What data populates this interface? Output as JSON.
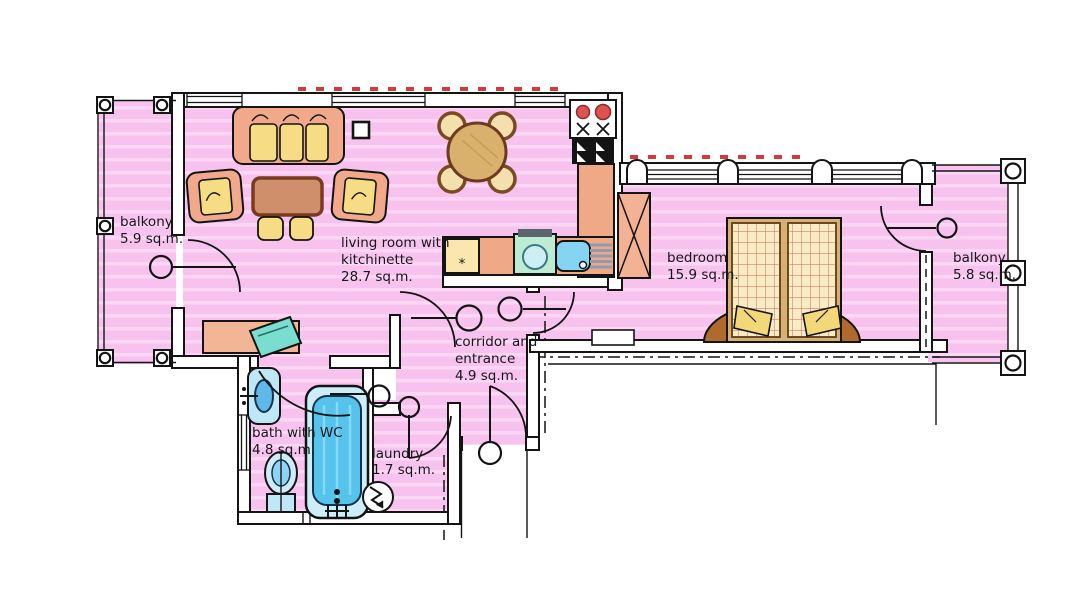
{
  "rooms": {
    "balcony_left": {
      "name": "balkony",
      "area": "5.9 sq.m."
    },
    "living": {
      "line1": "living room with",
      "line2": "kitchinette",
      "area": "28.7 sq.m."
    },
    "bedroom": {
      "name": "bedroom",
      "area": "15.9 sq.m."
    },
    "balcony_right": {
      "name": "balkony",
      "area": "5.8 sq.m."
    },
    "corridor": {
      "line1": "corridor and",
      "line2": "entrance",
      "area": "4.9 sq.m."
    },
    "bath": {
      "name": "bath with WC",
      "area": "4.8 sq.m."
    },
    "laundry": {
      "name": "laundry",
      "area": "1.7 sq.m."
    }
  },
  "kitchen": {
    "fridge_symbol": "*"
  },
  "colors": {
    "room_fill": "#f7c3ee",
    "room_fill_stripe": "#fbd7f5",
    "wall_fill": "#ffffff",
    "line": "#141414",
    "furniture_salmon": "#f2a98b",
    "cushion_yellow": "#f6dd85",
    "table_brown": "#d08f6b",
    "wood_dark": "#7a3a20",
    "bed_blanket": "#f7ecc4",
    "bed_plaid_line": "#d2806a",
    "headboard_brown": "#b06a2e",
    "fixture_light_blue": "#bfe7f5",
    "water_blue": "#5fc0ea",
    "appliance_teal": "#bdecd2",
    "burner_red": "#e05252",
    "radiator_red": "#d23b3b",
    "rack_gray": "#8f9bb0"
  }
}
